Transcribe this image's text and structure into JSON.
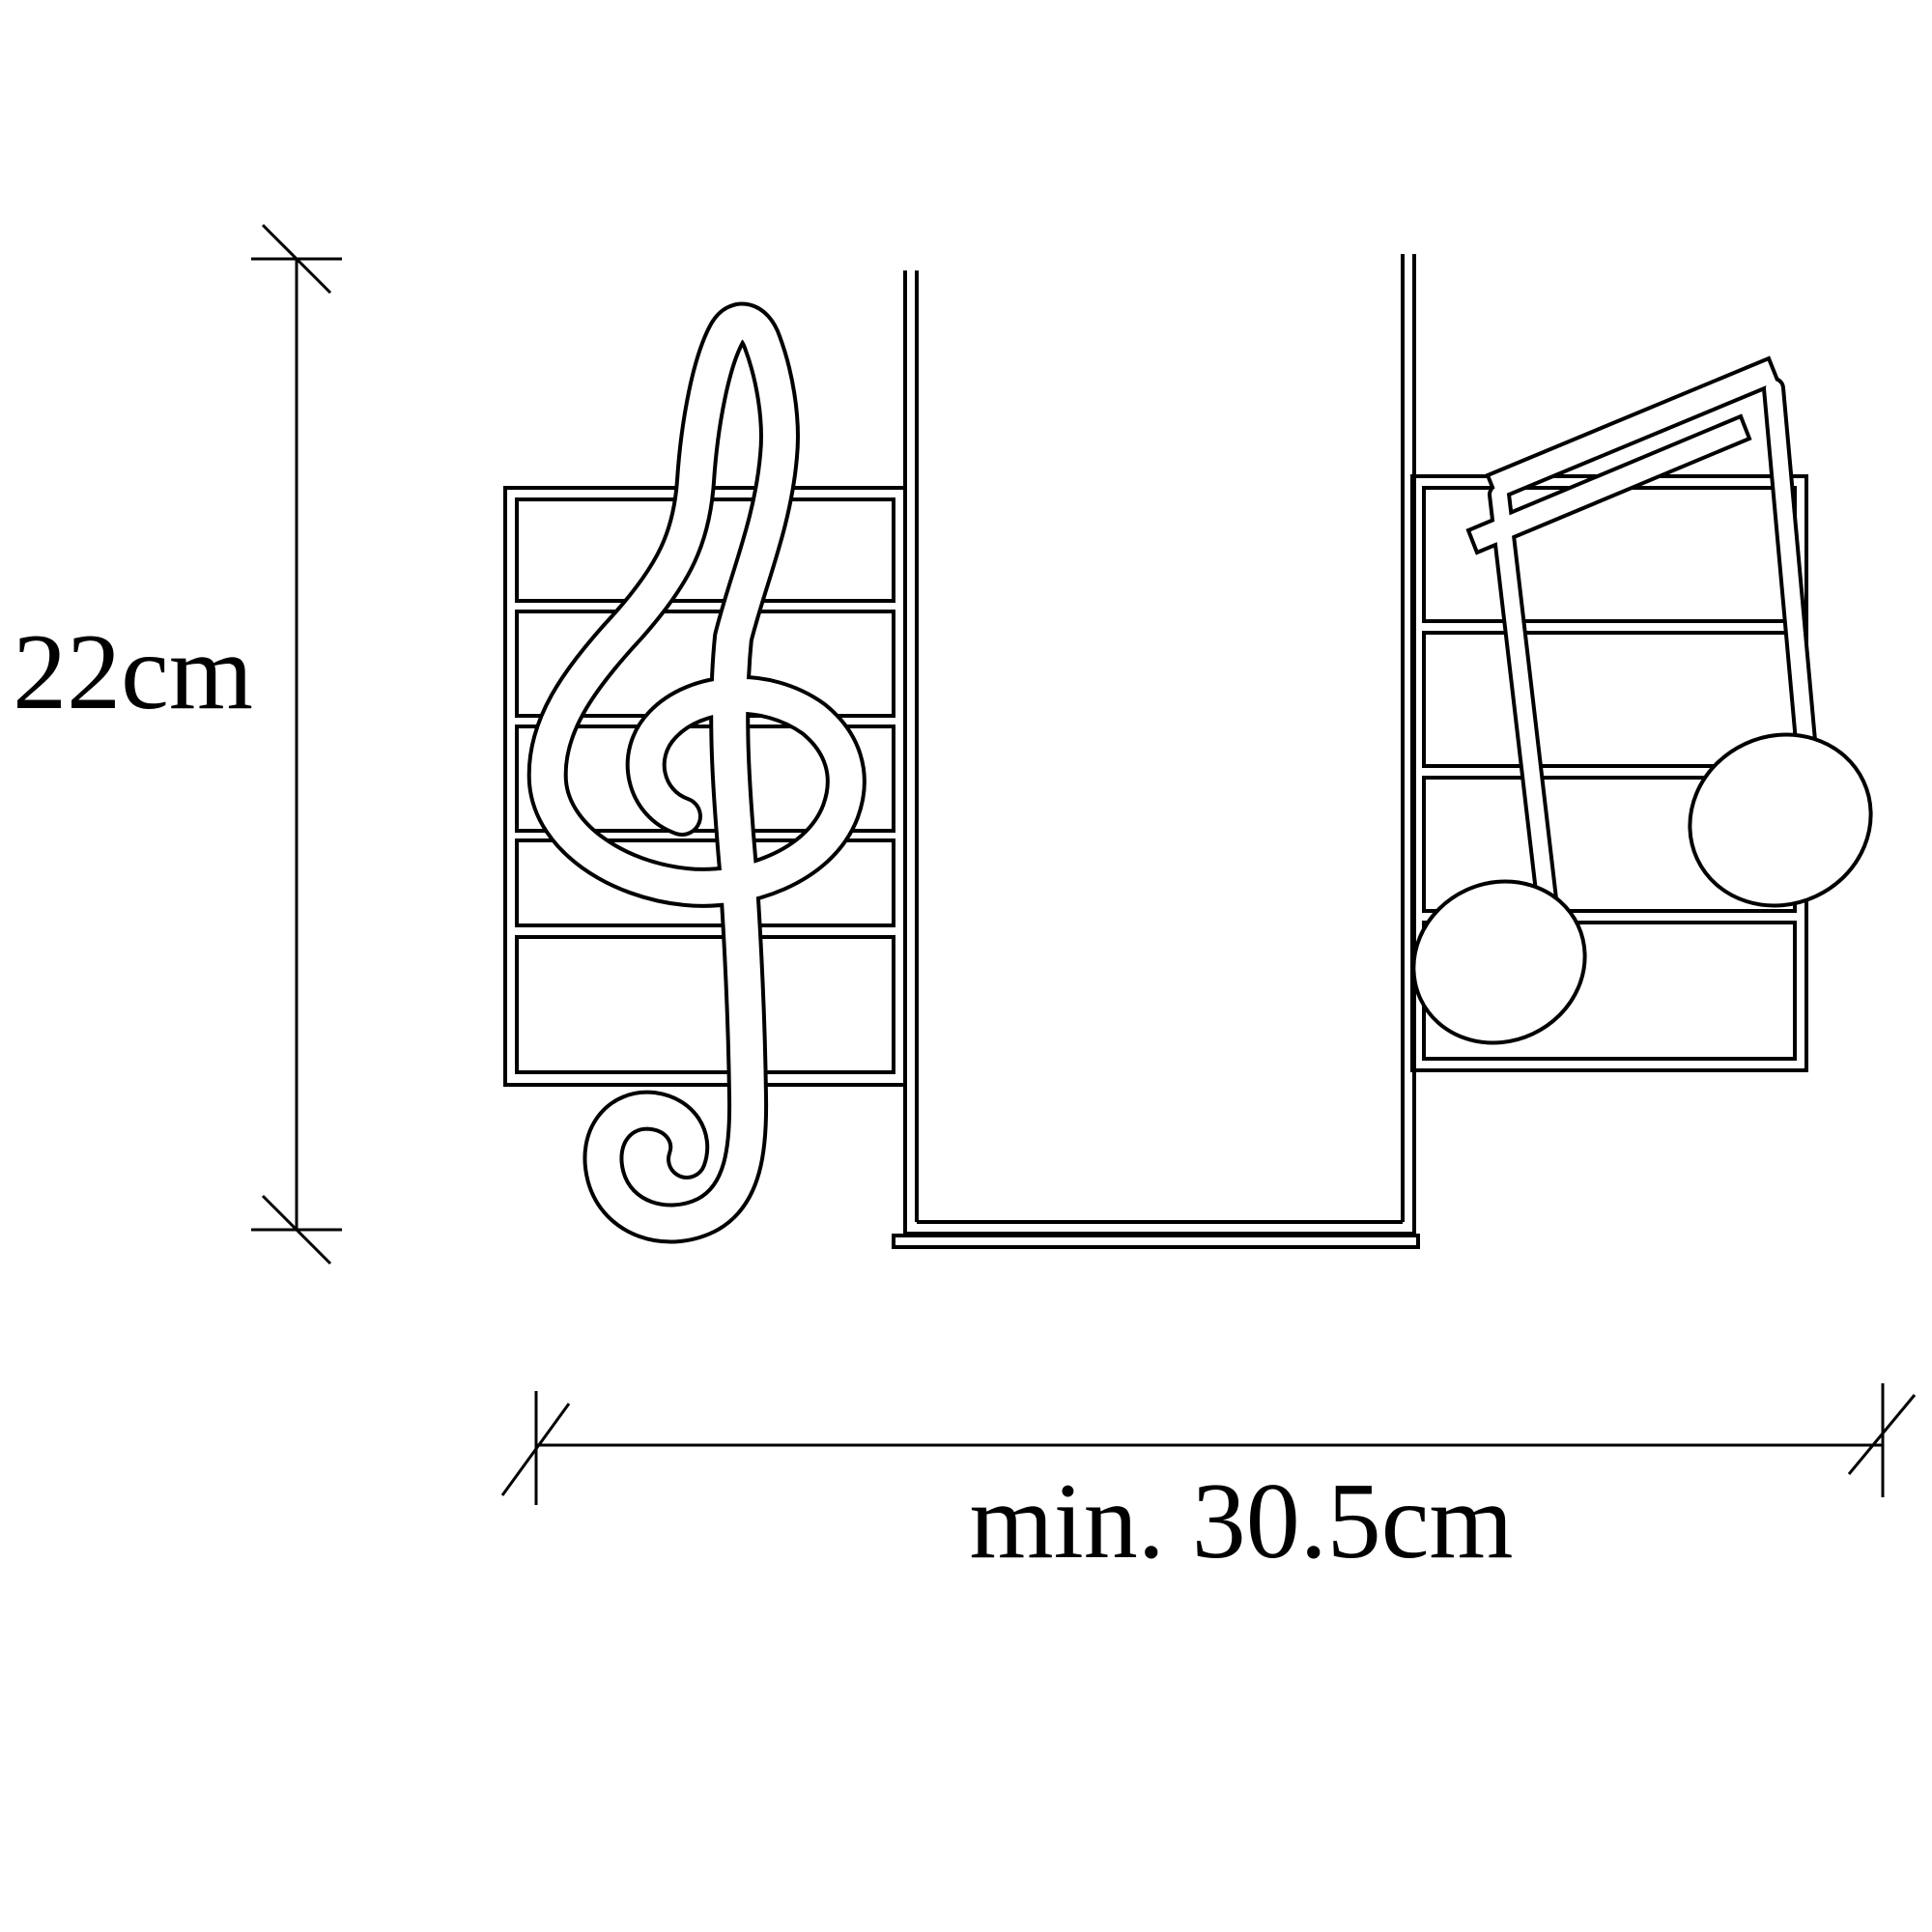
{
  "diagram": {
    "type": "technical-dimension-drawing",
    "subject": "music-note wall shelf, front view",
    "background_color": "#ffffff",
    "line_color": "#000000",
    "height_dimension_label": "22cm",
    "width_dimension_label": "min. 30.5cm",
    "parts": {
      "left_panel": "staff panel with treble clef cutout, 5 shelf slots",
      "center": "U-shaped shelf channel",
      "right_panel": "staff panel with beamed eighth notes cutout, 4 shelf slots"
    }
  }
}
